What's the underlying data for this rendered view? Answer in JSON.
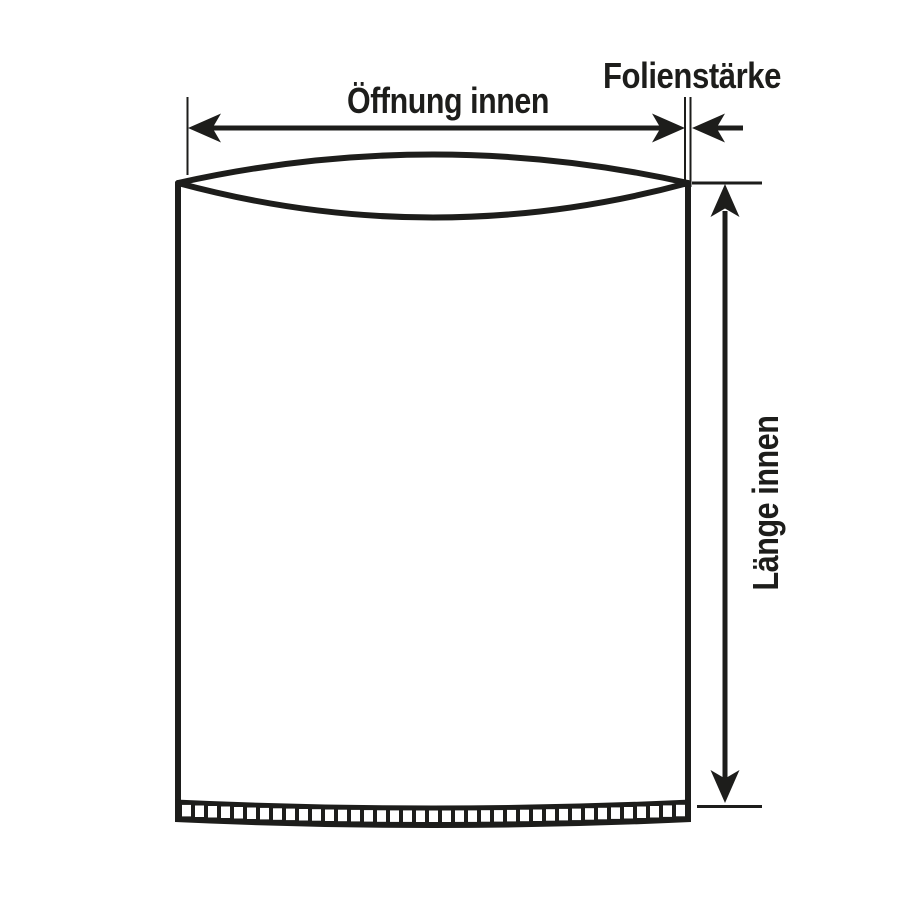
{
  "diagram": {
    "type": "technical-dimension-drawing",
    "subject": "flat plastic bag with bottom weld seam",
    "labels": {
      "opening_width": "Öffnung innen",
      "film_thickness": "Folienstärke",
      "inner_length": "Länge innen"
    }
  },
  "colors": {
    "line": "#1d1d1b",
    "background": "#ffffff"
  }
}
